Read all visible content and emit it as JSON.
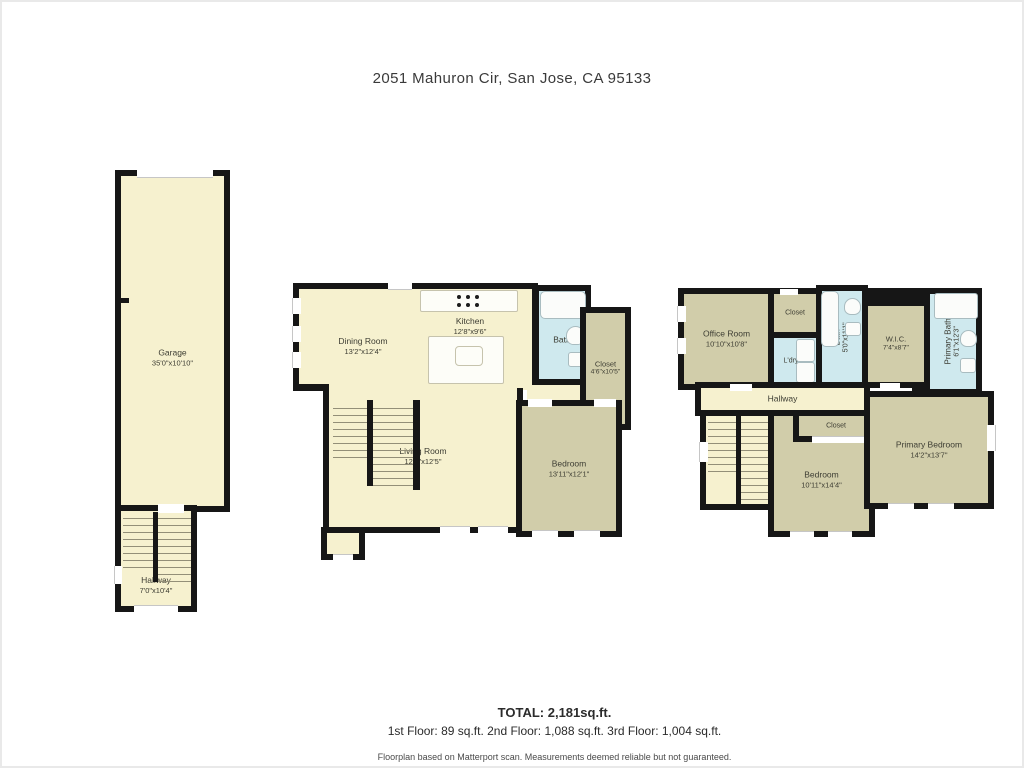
{
  "title": "2051 Mahuron Cir, San Jose, CA 95133",
  "colors": {
    "wall": "#161616",
    "room_cream": "#f6f1cf",
    "room_khaki": "#d1cdaa",
    "room_bath_blue": "#cfe9ee",
    "label_text": "#3d3d33"
  },
  "rooms": {
    "garage": {
      "name": "Garage",
      "dims": "35'0\"x10'10\""
    },
    "hallway1": {
      "name": "Hallway",
      "dims": "7'0\"x10'4\""
    },
    "dining": {
      "name": "Dining Room",
      "dims": "13'2\"x12'4\""
    },
    "kitchen": {
      "name": "Kitchen",
      "dims": "12'8\"x9'6\""
    },
    "bath2": {
      "name": "Bath"
    },
    "closet2": {
      "name": "Closet",
      "dims": "4'6\"x10'5\""
    },
    "living": {
      "name": "Living Room",
      "dims": "12'6\"x12'5\""
    },
    "bedroom2": {
      "name": "Bedroom",
      "dims": "13'11\"x12'1\""
    },
    "office": {
      "name": "Office Room",
      "dims": "10'10\"x10'8\""
    },
    "closet3a": {
      "name": "Closet"
    },
    "laundry": {
      "name": "L'dry"
    },
    "bath3": {
      "name": "Bath",
      "dims": "5'0\"x11'1\""
    },
    "wic": {
      "name": "W.I.C.",
      "dims": "7'4\"x8'7\""
    },
    "pbath": {
      "name": "Primary Bath",
      "dims": "6'1\"x12'3\""
    },
    "hallway3": {
      "name": "Hallway"
    },
    "closet3b": {
      "name": "Closet"
    },
    "bedroom3": {
      "name": "Bedroom",
      "dims": "10'11\"x14'4\""
    },
    "pbedroom": {
      "name": "Primary Bedroom",
      "dims": "14'2\"x13'7\""
    }
  },
  "footer": {
    "total": "TOTAL: 2,181sq.ft.",
    "floor_breakdown": "1st Floor: 89 sq.ft. 2nd Floor: 1,088 sq.ft.  3rd Floor: 1,004 sq.ft.",
    "disclaimer": "Floorplan based on Matterport scan. Measurements deemed reliable but not guaranteed."
  }
}
